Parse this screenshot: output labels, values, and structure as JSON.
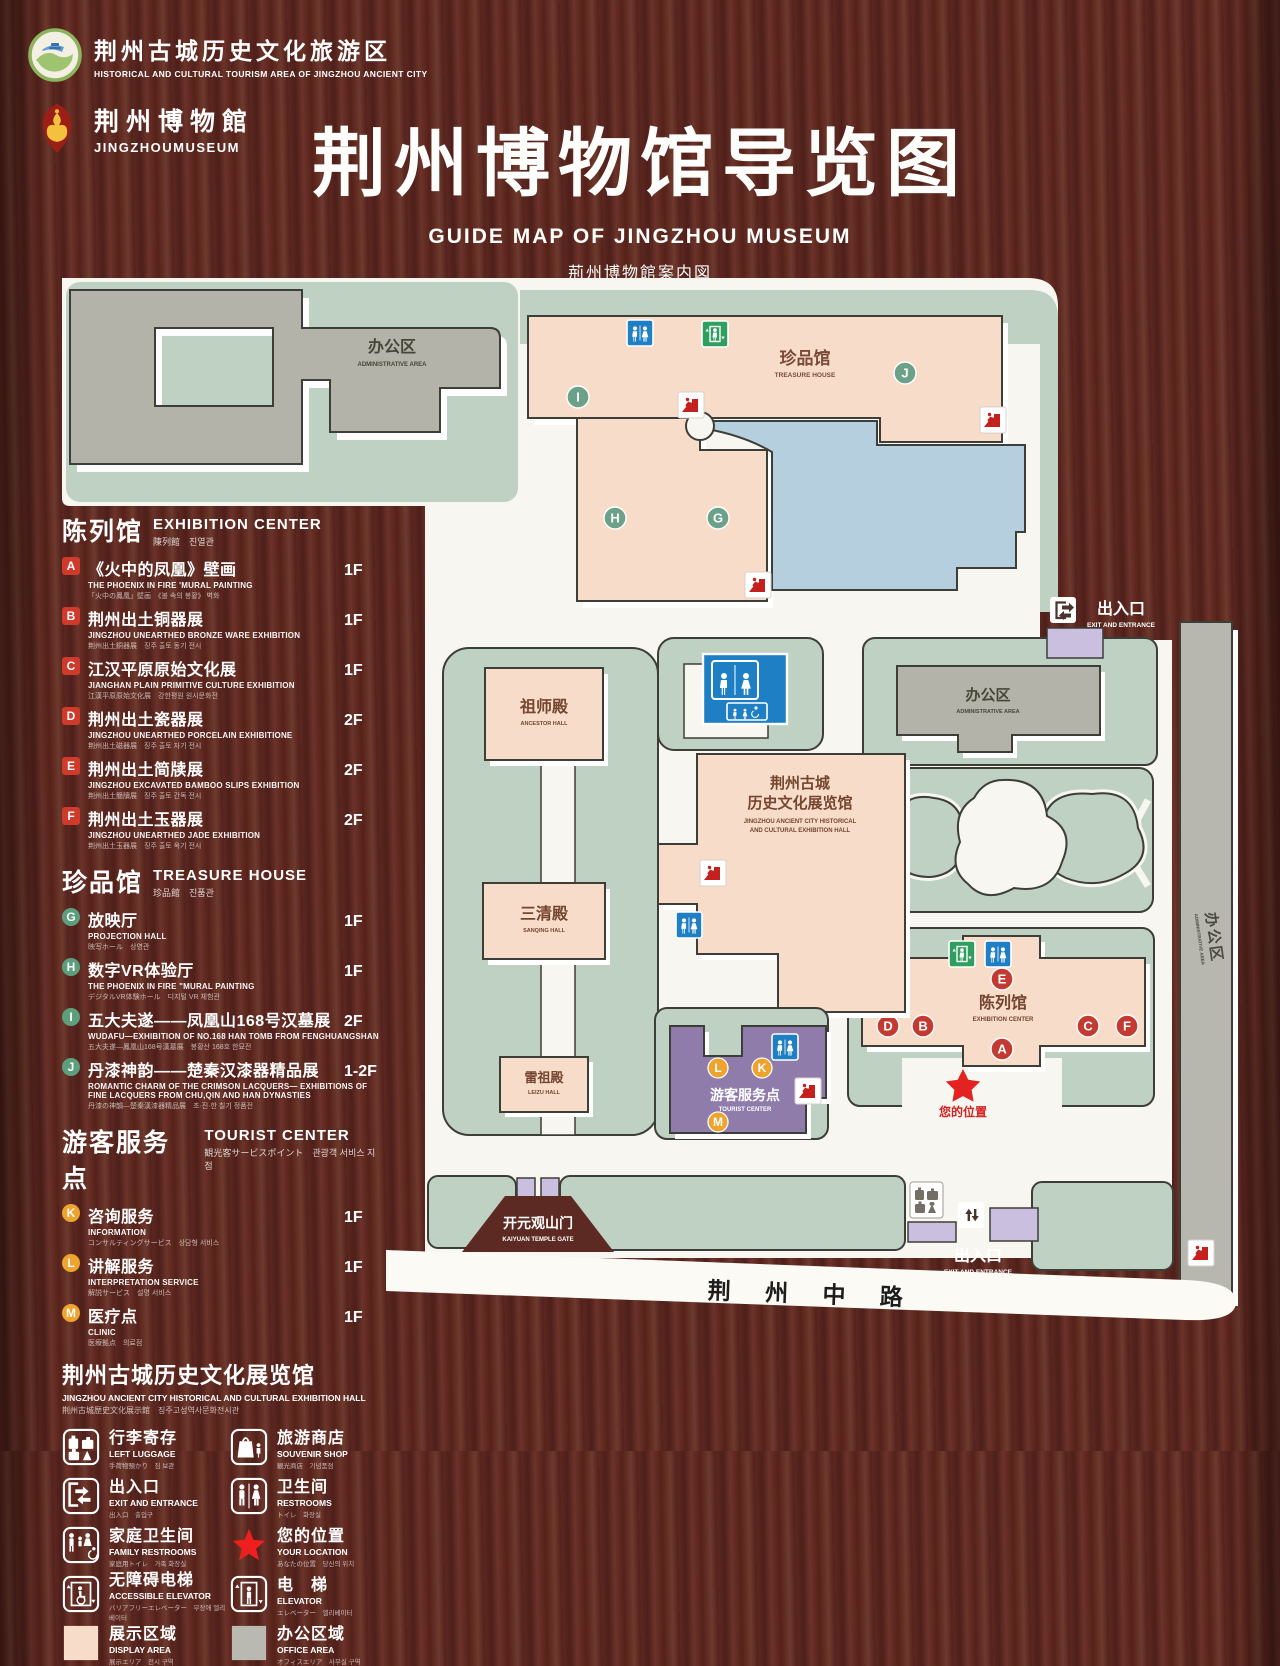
{
  "header": {
    "logo_tourism": {
      "name": "荆州古城历史文化旅游区",
      "name_en": "HISTORICAL AND CULTURAL TOURISM AREA OF JINGZHOU ANCIENT CITY"
    },
    "logo_museum": {
      "name": "荆州博物館",
      "name_en": "JINGZHOUMUSEUM"
    },
    "title": "荆州博物馆导览图",
    "title_en": "GUIDE MAP OF JINGZHOU MUSEUM",
    "title_ja": "荊州博物館案内図",
    "title_ko": "징주박물관 안내도"
  },
  "legend": {
    "sections": [
      {
        "title": "陈列馆",
        "title_en": "EXHIBITION CENTER",
        "title_sub": "陳列館　진열관",
        "items": [
          {
            "letter": "A",
            "name": "《火中的凤凰》壁画",
            "name_en": "THE PHOENIX IN FIRE 'MURAL PAINTING",
            "name_sub": "「火中の鳳凰」壁画　《불 속의 봉황》 벽화",
            "floor": "1F"
          },
          {
            "letter": "B",
            "name": "荆州出土铜器展",
            "name_en": "JINGZHOU UNEARTHED BRONZE WARE EXHIBITION",
            "name_sub": "荆州出土銅器展　징주 출토 동기 전시",
            "floor": "1F"
          },
          {
            "letter": "C",
            "name": "江汉平原原始文化展",
            "name_en": "JIANGHAN PLAIN PRIMITIVE CULTURE EXHIBITION",
            "name_sub": "江漢平原原始文化展　강한평원 원시문화전",
            "floor": "1F"
          },
          {
            "letter": "D",
            "name": "荆州出土瓷器展",
            "name_en": "JINGZHOU UNEARTHED PORCELAIN EXHIBITIONE",
            "name_sub": "荆州出土磁器展　징주 출토 자기 전시",
            "floor": "2F"
          },
          {
            "letter": "E",
            "name": "荆州出土简牍展",
            "name_en": "JINGZHOU EXCAVATED BAMBOO SLIPS EXHIBITION",
            "name_sub": "荆州出土簡牘展　징주 출토 간독 전시",
            "floor": "2F"
          },
          {
            "letter": "F",
            "name": "荆州出土玉器展",
            "name_en": "JINGZHOU UNEARTHED JADE EXHIBITION",
            "name_sub": "荆州出土玉器展　징주 출토 옥기 전시",
            "floor": "2F"
          }
        ]
      },
      {
        "title": "珍品馆",
        "title_en": "TREASURE HOUSE",
        "title_sub": "珍品館　진품관",
        "items": [
          {
            "letter": "G",
            "name": "放映厅",
            "name_en": "PROJECTION HALL",
            "name_sub": "映写ホール　상영관",
            "floor": "1F"
          },
          {
            "letter": "H",
            "name": "数字VR体验厅",
            "name_en": "THE PHOENIX IN FIRE \"MURAL PAINTING",
            "name_sub": "デジタルVR体験ホール　디지털 VR 체험관",
            "floor": "1F"
          },
          {
            "letter": "I",
            "name": "五大夫遂——凤凰山168号汉墓展",
            "name_en": "WUDAFU—EXHIBITION OF NO.168 HAN TOMB FROM FENGHUANGSHAN",
            "name_sub": "五大夫遂—鳳凰山168号漢墓展　봉황산 168호 한묘전",
            "floor": "2F"
          },
          {
            "letter": "J",
            "name": "丹漆神韵——楚秦汉漆器精品展",
            "name_en": "ROMANTIC CHARM OF THE CRIMSON LACQUERS— EXHIBITIONS OF FINE LACQUERS FROM CHU,QIN AND HAN DYNASTIES",
            "name_sub": "丹漆の神韻—楚秦漢漆器精品展　초·진·한 칠기 정품전",
            "floor": "1-2F"
          }
        ]
      },
      {
        "title": "游客服务点",
        "title_en": "TOURIST CENTER",
        "title_sub": "観光客サービスポイント　관광객 서비스 지점",
        "items": [
          {
            "letter": "K",
            "name": "咨询服务",
            "name_en": "INFORMATION",
            "name_sub": "コンサルティングサービス　상담형 서비스",
            "floor": "1F"
          },
          {
            "letter": "L",
            "name": "讲解服务",
            "name_en": "INTERPRETATION SERVICE",
            "name_sub": "解説サービス　설명 서비스",
            "floor": "1F"
          },
          {
            "letter": "M",
            "name": "医疗点",
            "name_en": "CLINIC",
            "name_sub": "医療拠点　의료점",
            "floor": "1F"
          }
        ]
      }
    ],
    "hall_note": {
      "title": "荆州古城历史文化展览馆",
      "title_en": "JINGZHOU ANCIENT CITY HISTORICAL AND CULTURAL EXHIBITION HALL",
      "title_sub": "荆州古城歴史文化展示館　징주고성역사문화전시관"
    },
    "icons": [
      {
        "name": "行李寄存",
        "name_en": "LEFT LUGGAGE",
        "name_sub": "手荷物預かり　짐 보관"
      },
      {
        "name": "旅游商店",
        "name_en": "SOUVENIR SHOP",
        "name_sub": "観光商店　기념품점"
      },
      {
        "name": "出入口",
        "name_en": "EXIT AND ENTRANCE",
        "name_sub": "出入口　출입구"
      },
      {
        "name": "卫生间",
        "name_en": "RESTROOMS",
        "name_sub": "トイレ　화장실"
      },
      {
        "name": "家庭卫生间",
        "name_en": "FAMILY RESTROOMS",
        "name_sub": "家庭用トイレ　가족 화장실"
      },
      {
        "name": "您的位置",
        "name_en": "YOUR LOCATION",
        "name_sub": "あなたの位置　당신의 위치"
      },
      {
        "name": "无障碍电梯",
        "name_en": "ACCESSIBLE ELEVATOR",
        "name_sub": "バリアフリーエレベーター　무장애 엘리베이터"
      },
      {
        "name": "电　梯",
        "name_en": "ELEVATOR",
        "name_sub": "エレベーター　엘리베이터"
      },
      {
        "name": "展示区域",
        "name_en": "DISPLAY AREA",
        "name_sub": "展示エリア　전시 구역"
      },
      {
        "name": "办公区域",
        "name_en": "OFFICE AREA",
        "name_sub": "オフィスエリア　사무실 구역"
      }
    ]
  },
  "map": {
    "admin_top": {
      "name": "办公区",
      "name_en": "ADMINISTRATIVE AREA"
    },
    "treasure_house": {
      "name": "珍品馆",
      "name_en": "TREASURE HOUSE"
    },
    "ancestor_hall": {
      "name": "祖师殿",
      "name_en": "ANCESTOR HALL"
    },
    "sanqing_hall": {
      "name": "三清殿",
      "name_en": "SANQING HALL"
    },
    "leizu_hall": {
      "name": "雷祖殿",
      "name_en": "LEIZU HALL"
    },
    "history_hall": {
      "name_line1": "荆州古城",
      "name_line2": "历史文化展览馆",
      "name_en_line1": "JINGZHOU ANCIENT CITY HISTORICAL",
      "name_en_line2": "AND CULTURAL EXHIBITION HALL"
    },
    "admin_right": {
      "name": "办公区",
      "name_en": "ADMINISTRATIVE AREA"
    },
    "admin_strip": {
      "name": "办公区",
      "name_en": "ADMINISTRATIVE AREA"
    },
    "exhibition_center": {
      "name": "陈列馆",
      "name_en": "EXHIBITION CENTER"
    },
    "tourist_center": {
      "name": "游客服务点",
      "name_en": "TOURIST CENTER"
    },
    "your_location": {
      "name": "您的位置"
    },
    "exit_top": {
      "name": "出入口",
      "name_en": "EXIT AND ENTRANCE"
    },
    "exit_bottom": {
      "name": "出入口",
      "name_en": "EXIT AND ENTRANCE"
    },
    "kaiyuan_gate": {
      "name": "开元观山门",
      "name_en": "KAIYUAN TEMPLE GATE"
    },
    "road": {
      "name": "荆 州 中 路"
    },
    "markers": {
      "A": "A",
      "B": "B",
      "C": "C",
      "D": "D",
      "E": "E",
      "F": "F",
      "G": "G",
      "H": "H",
      "I": "I",
      "J": "J",
      "K": "K",
      "L": "L",
      "M": "M"
    }
  },
  "colors": {
    "wood": "#58241e",
    "paper": "#f8f6f0",
    "ground_green": "#bed1c2",
    "building_pink": "#f7dcc9",
    "building_gray": "#b3b3aa",
    "lake_blue": "#b6cfde",
    "tourist_purple": "#8f7cab",
    "gate_purple": "#cabfdf",
    "icon_red": "#c4201d",
    "icon_blue": "#1f7fc4",
    "icon_green": "#2f9e5f",
    "marker_green": "#6aa188",
    "marker_red": "#c23a32",
    "marker_orange": "#efa32f",
    "star_red": "#e32222"
  }
}
